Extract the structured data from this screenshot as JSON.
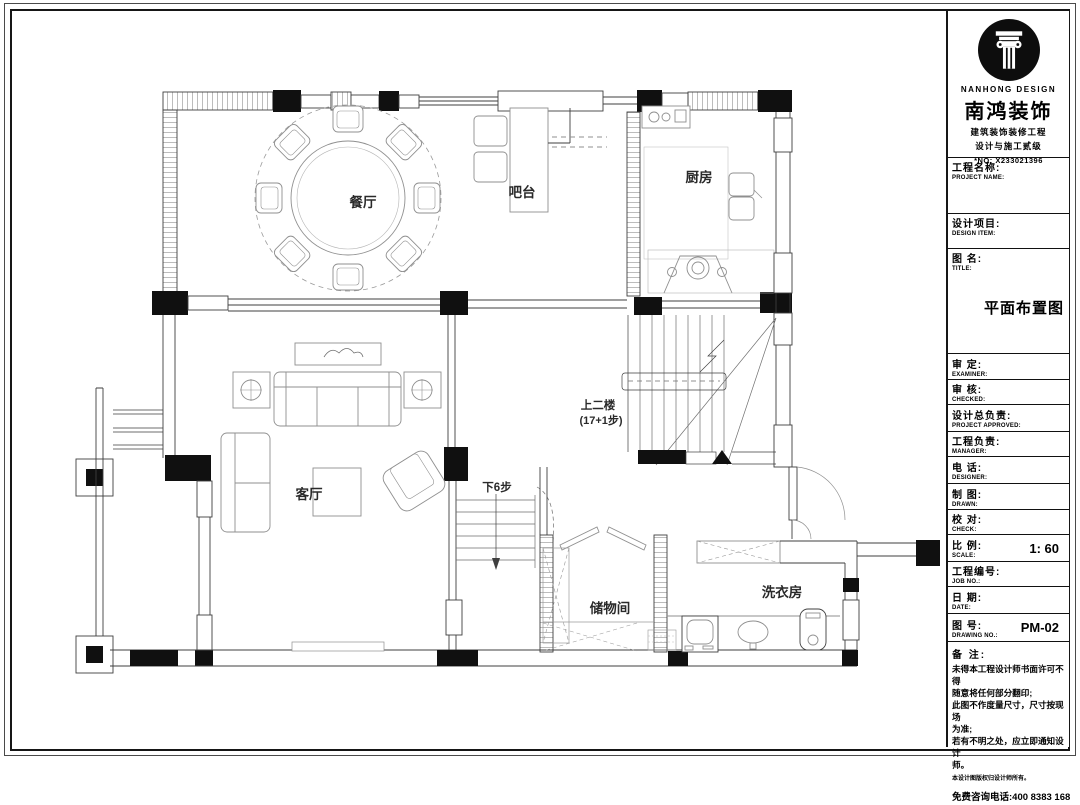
{
  "title_block": {
    "brand_en": "NANHONG DESIGN",
    "brand_zh": "南鸿装饰",
    "cert_line1": "建筑装饰装修工程",
    "cert_line2": "设计与施工贰级",
    "cert_no": "*NO: X233021396",
    "rows": [
      {
        "zh": "工程名称:",
        "en": "PROJECT NAME:"
      },
      {
        "zh": "设计项目:",
        "en": "DESIGN ITEM:"
      },
      {
        "zh": "图 名:",
        "en": "TITLE:"
      },
      {
        "zh": "审 定:",
        "en": "EXAMINER:"
      },
      {
        "zh": "审 核:",
        "en": "CHECKED:"
      },
      {
        "zh": "设计总负责:",
        "en": "PROJECT APPROVED:"
      },
      {
        "zh": "工程负责:",
        "en": "MANAGER:"
      },
      {
        "zh": "电 话:",
        "en": "DESIGNER:"
      },
      {
        "zh": "制 图:",
        "en": "DRAWN:"
      },
      {
        "zh": "校 对:",
        "en": "CHECK:"
      },
      {
        "zh": "比 例:",
        "en": "SCALE:"
      },
      {
        "zh": "工程编号:",
        "en": "JOB NO.:"
      },
      {
        "zh": "日 期:",
        "en": "DATE:"
      },
      {
        "zh": "图 号:",
        "en": "DRAWING NO.:"
      }
    ],
    "drawing_title": "平面布置图",
    "scale_value": "1: 60",
    "drawing_no_value": "PM-02",
    "notes_label": "备 注:",
    "notes": [
      "未得本工程设计师书面许可不得",
      "随意将任何部分翻印;",
      "此图不作度量尺寸，尺寸按现场",
      "为准;",
      "若有不明之处，应立即通知设计",
      "师。"
    ],
    "copyright_note": "本设计图版权归设计师所有。",
    "hotline": "免费咨询电话:400 8383 168"
  },
  "plan": {
    "labels": {
      "dining": "餐厅",
      "bar": "吧台",
      "kitchen": "厨房",
      "living": "客厅",
      "stairs_up_line1": "上二楼",
      "stairs_up_line2": "(17+1步)",
      "stairs_down": "下6步",
      "storage": "储物间",
      "laundry": "洗衣房"
    }
  }
}
